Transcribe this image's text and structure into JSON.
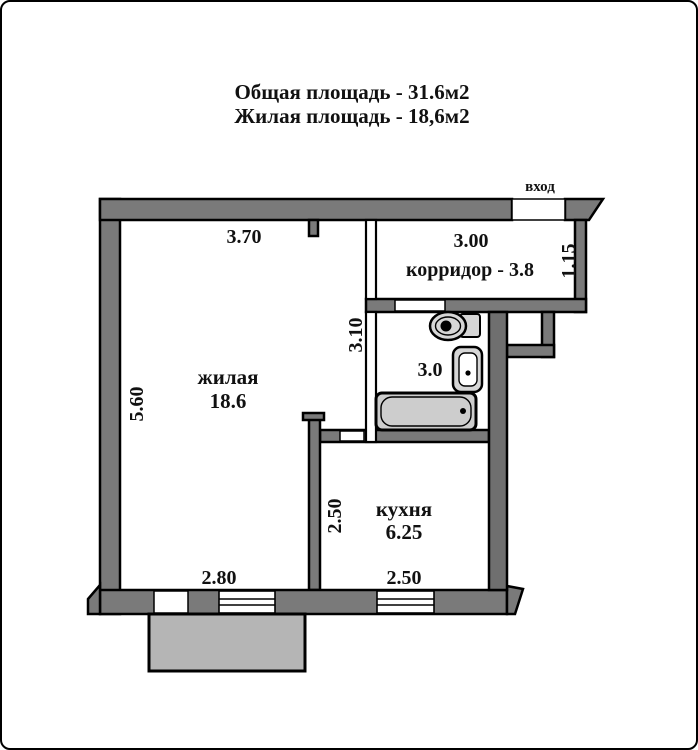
{
  "title": {
    "line1": "Общая площадь - 31.6м2",
    "line2": "Жилая площадь - 18,6м2"
  },
  "labels": {
    "entrance": "вход"
  },
  "rooms": {
    "living": {
      "name": "жилая",
      "area": "18.6"
    },
    "corridor": {
      "label": "корридор - 3.8"
    },
    "bathroom": {
      "area": "3.0"
    },
    "kitchen": {
      "name": "кухня",
      "area": "6.25"
    }
  },
  "dimensions": {
    "living_top": "3.70",
    "living_left": "5.60",
    "living_bottom": "2.80",
    "passage_right": "3.10",
    "corridor_top": "3.00",
    "corridor_right": "1.15",
    "kitchen_left": "2.50",
    "kitchen_bottom": "2.50"
  },
  "colors": {
    "wall": "#7a7a7a",
    "wall_dark": "#6f6f6f",
    "outline": "#000000",
    "balcony_fill": "#b5b5b5",
    "fixture_fill": "#d6d6d6",
    "bathtub_fill": "#cdcdcd",
    "background": "#ffffff"
  }
}
